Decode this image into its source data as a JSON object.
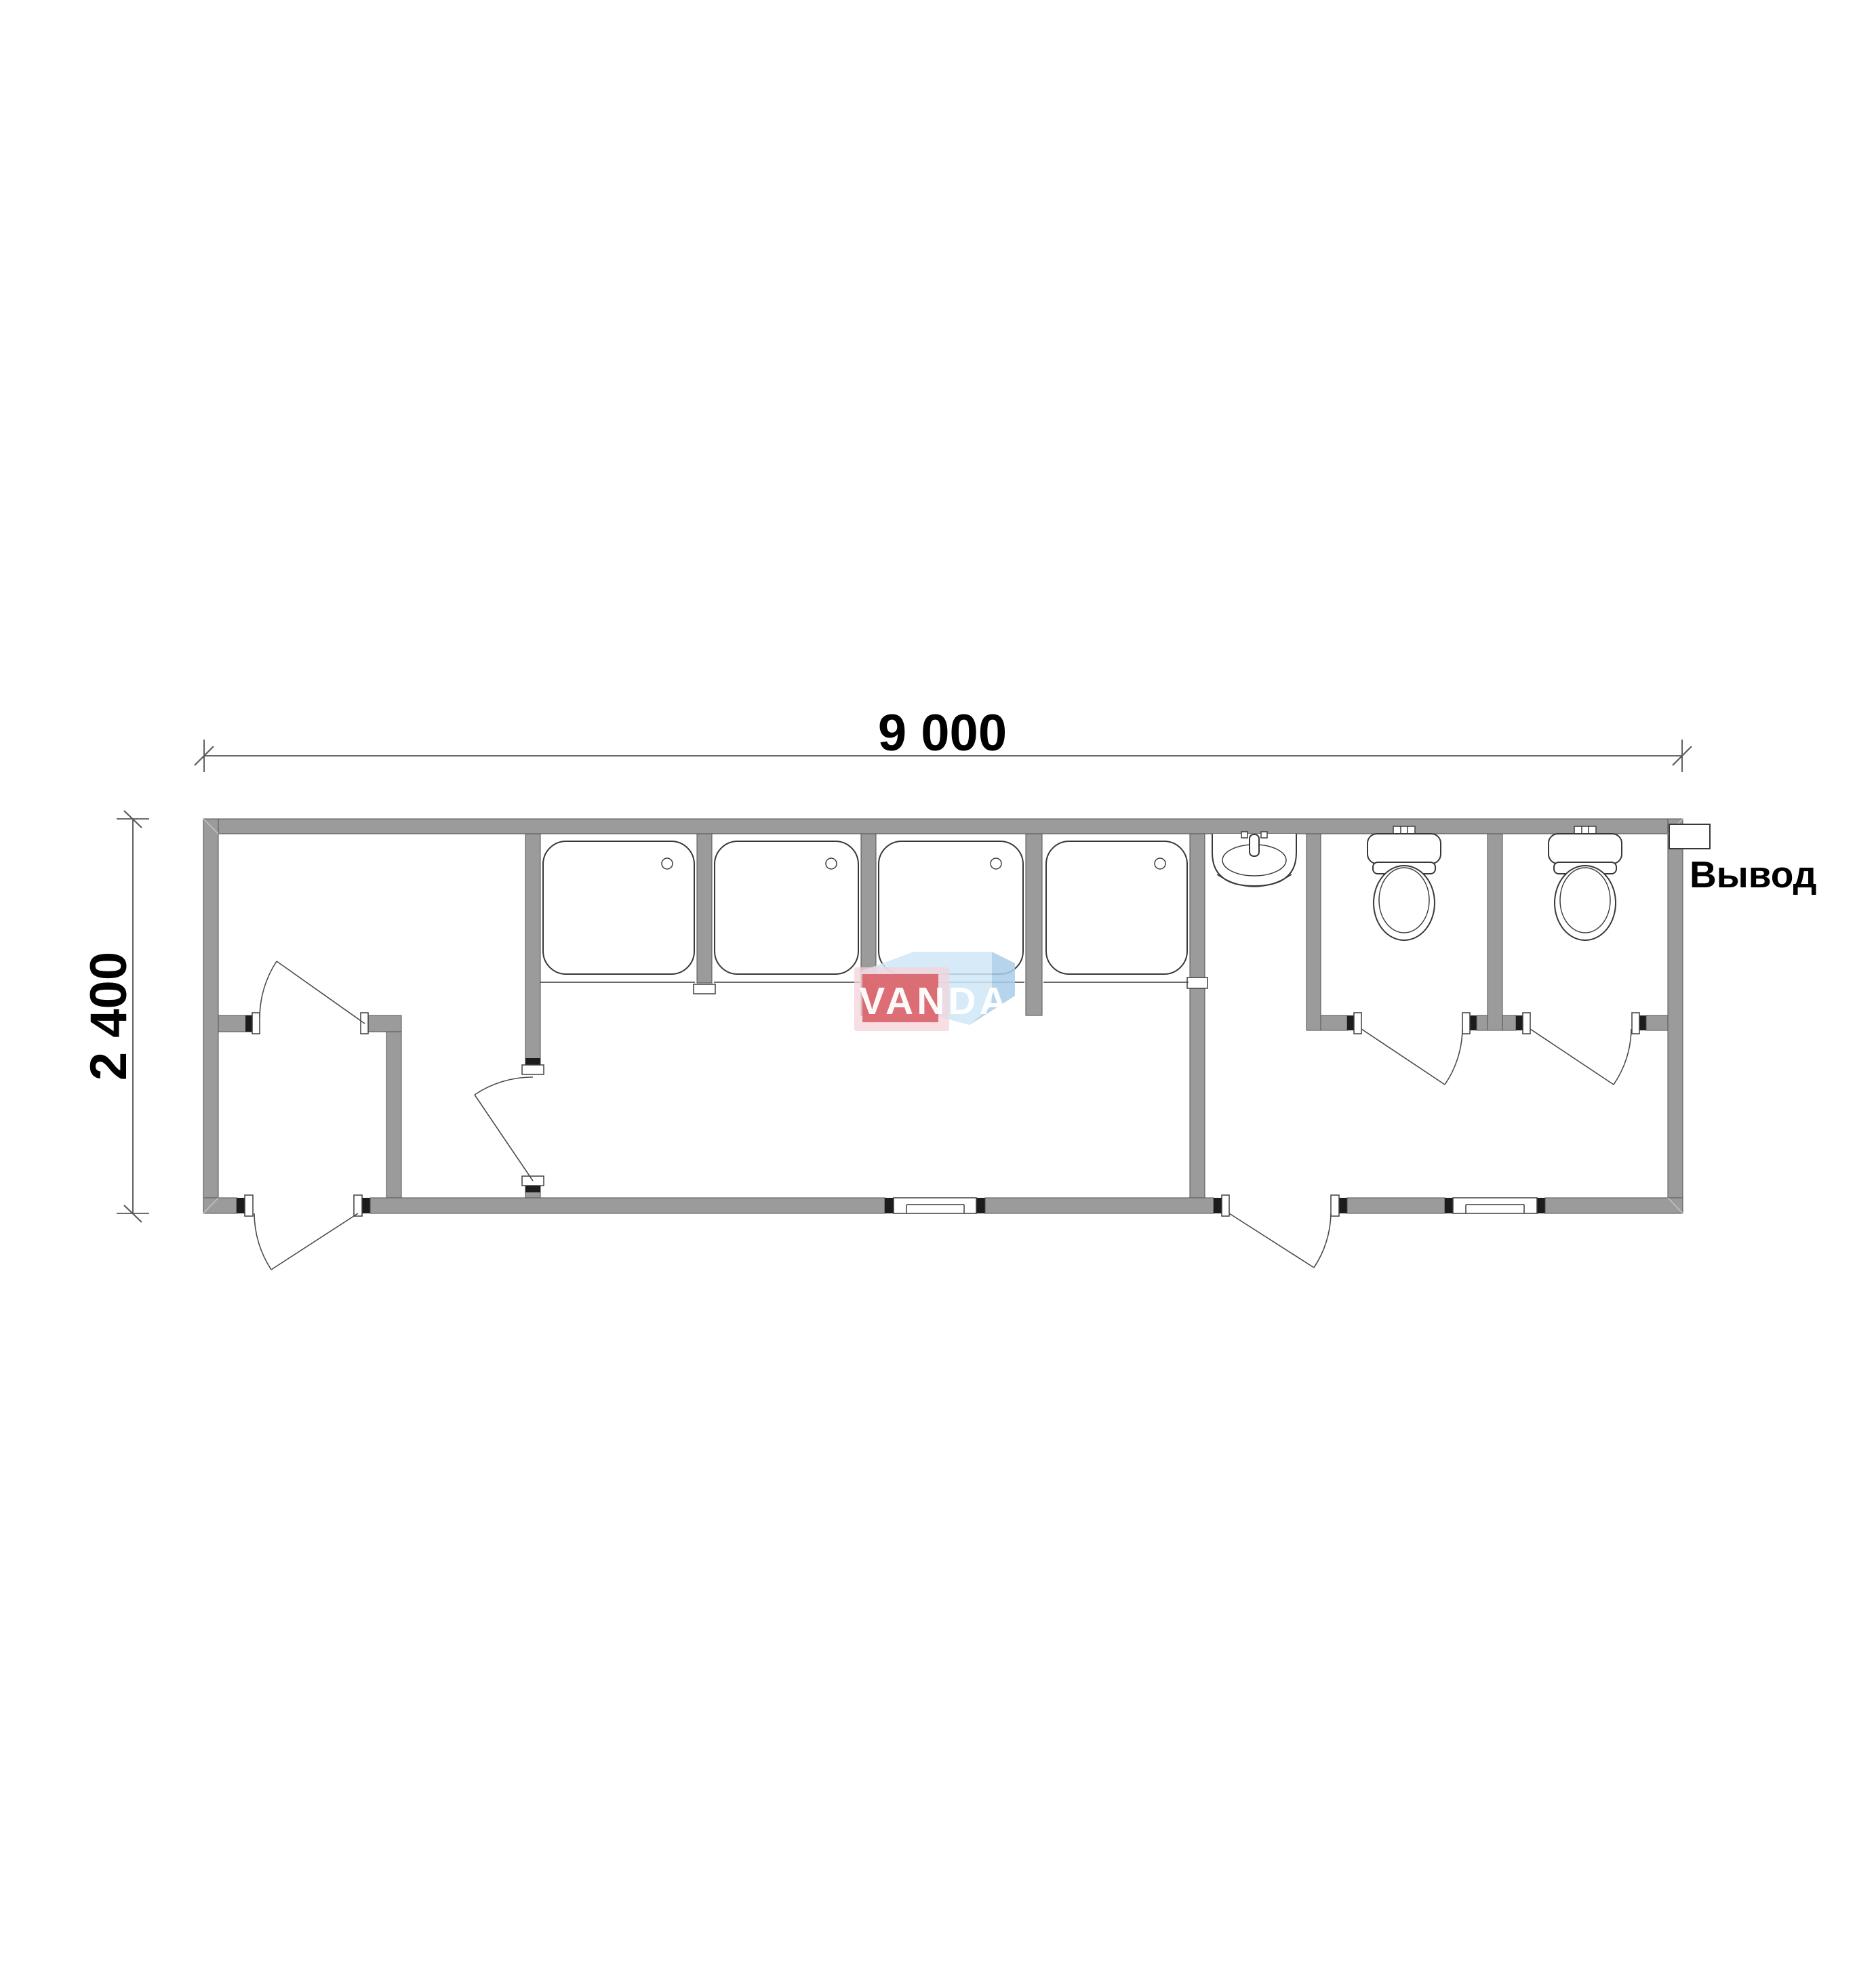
{
  "dimensions": {
    "width": {
      "label": "9 000"
    },
    "height": {
      "label": "2 400"
    }
  },
  "labels": {
    "outlet": "Вывод"
  },
  "watermark": {
    "text": "VANDA",
    "colors": {
      "red": "#d85a61",
      "pink_halo": "#f3d3d9",
      "blue_light": "#cfe6f7",
      "blue_dark": "#a9cce8",
      "text": "#ffffff"
    }
  },
  "plan": {
    "wall_color": "#9b9b9b",
    "fixtures": {
      "shower_trays": 4,
      "washbasins": 1,
      "toilets": 2,
      "windows": 2,
      "doors": 6,
      "outlet_boxes": 1
    }
  }
}
